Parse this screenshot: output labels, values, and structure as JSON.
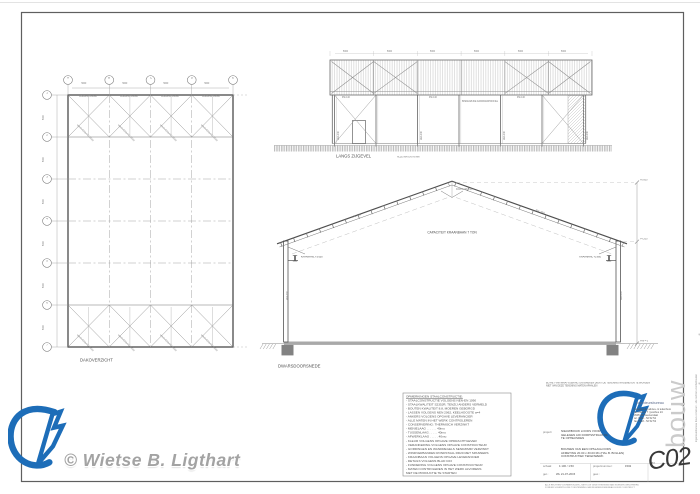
{
  "page": {
    "copyright": "© Wietse B. Ligthart"
  },
  "plan": {
    "title": "DAKOVERZICHT",
    "grid_top": [
      "A",
      "B",
      "C",
      "D",
      "E"
    ],
    "grid_left": [
      "1",
      "2",
      "3",
      "4",
      "5",
      "6",
      "7"
    ],
    "dim_top": "5000",
    "dim_left": "5000",
    "chord_label": "GORDING 160/60",
    "brace_label": "WINDVERBAND RD20"
  },
  "elevation": {
    "title": "LANGS ZIJGEVEL",
    "note": "ALLE MATEN IN MM",
    "dim_label": "5000",
    "panel_label": "IPE 140",
    "column_label": "HEA 240",
    "wall_note": "BINNENZIJDE DAMWANDPROFIEL"
  },
  "section": {
    "title": "DWARSDOORSNEDE",
    "capacity_note": "CAPACITEIT KRAANBAAN 7 TON",
    "level_top": "+6.600",
    "level_eaves": "+4.200",
    "level_ground": "Peil = 0",
    "crane_left": "KRAANRAIL +3.600",
    "crane_right": "KRAANRAIL +3.600",
    "rafter_label": "IPE 330",
    "column_label": "HEA 300",
    "apex_label": "KOPPLAAT t=20"
  },
  "notes": {
    "lines": [
      "OPMERKINGEN STAALCONSTRUCTIE:",
      "- STAALCONSTRUCTIE VOLGENS NEN-EN 1090",
      "- STAALKWALITEIT S235JR, TENZIJ ANDERS VERMELD",
      "- BOUTEN KWALITEIT 8.8, MOEREN GEBORGD",
      "- LASSEN VOLGENS NEN 2062, KEELHOOGTE a=4",
      "- ANKERS VOLGENS OPGAVE LEVERANCIER",
      "- ALLE MATEN IN HET WERK CONTROLEREN",
      "- CONSERVERING: THERMISCH VERZINKT",
      "- MENIELAAG . . . . . . 40mu",
      "- TUSSENLAAG . . . . . 40mu",
      "- AFWERKLAAG . . . . . 40mu",
      "- KLEUR VOLGENS OPGAVE OPDRACHTGEVER",
      "- VERANKERING VOLGENS OPGAVE CONSTRUCTEUR",
      "- GORDINGEN EN WANDREGELS SENDZIMIR VERZINKT",
      "- WINDVERBANDEN RONDSTAAL RD20 MET SPANNERS",
      "- KRAANBAAN VOLGENS OPGAVE LEVERANCIER",
      "- DETAILS VOLGENS BLAD C03",
      "- FUNDERING VOLGENS OPGAVE CONSTRUCTEUR",
      "- MATEN CONTROLEREN IN HET WERK ALVORENS",
      "  MET DE PRODUCTIE TE STARTEN"
    ]
  },
  "titleblock": {
    "disclaimer1": "BIJ HET VAN MAATVOERING ONTBREKEN DIENT DE TEKENING NAGEMETEN TE WORDEN",
    "disclaimer2": "NIET VAN DEZE TEKENING MATEN AFHALEN",
    "brand": "bouw construct",
    "brand_type": "ingenieursbureau",
    "address": [
      "bouwkundig advies- & tekenburo",
      "de omloop 7  |  postbus 24",
      "3905 AB  Veenendaal",
      "tel.  0318 - 52 52 52",
      "fax  0318 - 52 52 53"
    ],
    "side_note": "ingenieursbureau bouw construct  ·  alle rechten voorbehouden",
    "project_label": "project:",
    "project_lines": [
      "NIEUWBOUW LOODS VOOR",
      "GELEGEN A/D DORPSSTRAAT 84",
      "TE OPHEUSDEN"
    ],
    "description_lines": [
      "BOUWEN VAN EEN OPSLAGLOODS",
      "AFMETING 20.00 x 30.00 M1  (HAL B. BOLLEN)",
      "CONSTRUCTIEF TEKENWERK"
    ],
    "scale_label": "schaal:",
    "scale_value": "1:100 / 1:50",
    "projectno_label": "projectnummer:",
    "projectno_value": "1502",
    "drawn_label": "get.:",
    "drawn_value": "WL  21-07-2015",
    "revised_label": "gew.:",
    "revised_value": "",
    "sheet_label": "blad:",
    "sheet_value": "C02",
    "footer1": "ALLE RECHTEN VOORBEHOUDEN - NIETS UIT DEZE TEKENING MAG WORDEN GEKOPIEERD",
    "footer2": "ZONDER SCHRIFTELIJKE TOESTEMMING VAN INGENIEURSBUREAU BOUW CONSTRUCT"
  }
}
